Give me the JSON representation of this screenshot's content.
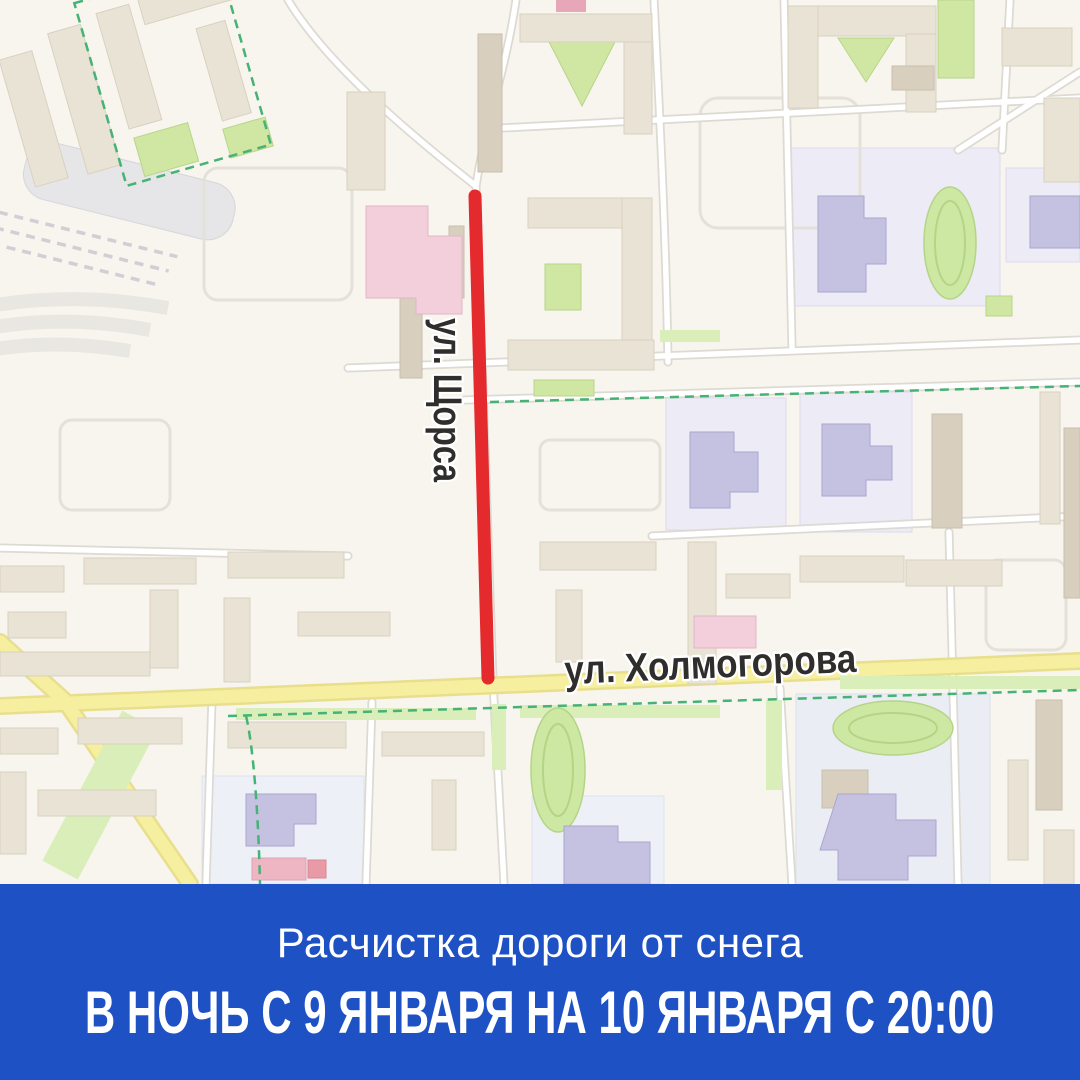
{
  "map": {
    "street_vertical_label": "ул. Щорса",
    "street_horizontal_label": "ул. Холмогорова",
    "highlight": "red-route-segment"
  },
  "banner": {
    "subtitle": "Расчистка дороги от снега",
    "title": "В НОЧЬ С 9 ЯНВАРЯ НА 10 ЯНВАРЯ С 20:00"
  },
  "colors": {
    "accent_red": "#e42a2c",
    "banner_blue": "#1e52c4",
    "map_bg": "#f7f5ee",
    "road_yellow": "#f6ef9f",
    "building": "#e9e3d5",
    "building_stroke": "#d9d1c0",
    "building_dark": "#d8cfbe",
    "lavender_zone": "#ecebf6",
    "purple_building": "#c5c2e1",
    "pink_building": "#f3cfdc",
    "green": "#cfe7a3",
    "green_strip": "#d9eeb8",
    "stadium_green": "#cde8a2",
    "dash_green": "#46b275",
    "label_color": "#2f2e2c"
  }
}
